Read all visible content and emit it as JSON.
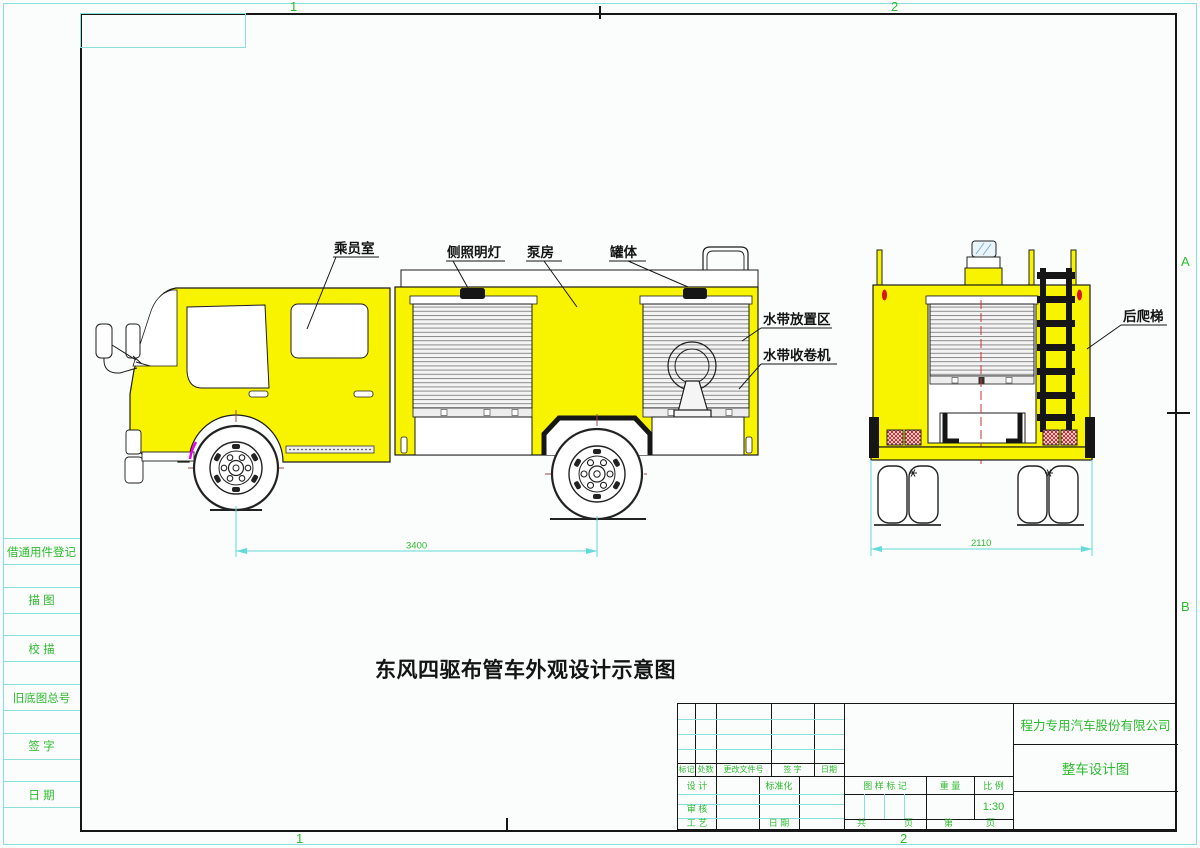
{
  "drawing": {
    "main_title": "东风四驱布管车外观设计示意图"
  },
  "edge_markers": {
    "top_1": "1",
    "top_2": "2",
    "bottom_1": "1",
    "bottom_2": "2",
    "right_a": "A",
    "right_b": "B"
  },
  "left_strip": {
    "labels": [
      "借通用件登记",
      "描 图",
      "校 描",
      "旧底图总号",
      "签 字",
      "日 期"
    ]
  },
  "side_view": {
    "label_crew_cab": "乘员室",
    "label_side_lamp": "侧照明灯",
    "label_pump_room": "泵房",
    "label_tank": "罐体",
    "label_hose_area": "水带放置区",
    "label_hose_reel": "水带收卷机",
    "dimension_wheelbase": "3400"
  },
  "rear_view": {
    "label_rear_ladder": "后爬梯",
    "dimension_width": "2110"
  },
  "title_block": {
    "company": "程力专用汽车股份有限公司",
    "drawing_name": "整车设计图",
    "rev_headers": [
      "标记",
      "处数",
      "更改文件号",
      "签 字",
      "日期"
    ],
    "design_label": "设 计",
    "standardization_label": "标准化",
    "check_label": "审 核",
    "process_label": "工 艺",
    "date_label": "日 期",
    "mark_label": "图 样 标 记",
    "weight_label": "重 量",
    "scale_label": "比 例",
    "scale_value": "1:30",
    "pages_total_label": "共",
    "pages_total_unit": "页",
    "pages_current_label": "第",
    "pages_current_unit": "页"
  },
  "colors": {
    "body_yellow": "#f8f400",
    "annotation_green": "#2dbb2d",
    "dimension_cyan": "#66d9d9",
    "centerline_red": "#9c4a4a"
  }
}
